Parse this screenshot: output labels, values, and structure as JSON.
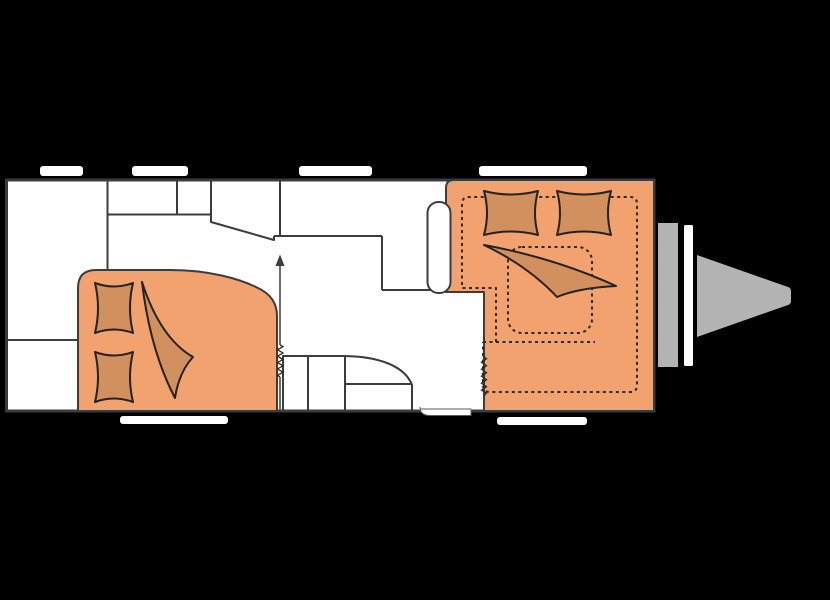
{
  "scene": {
    "type": "caravan-floorplan-diagram",
    "background": "#000000"
  },
  "colors": {
    "floor": "#ffffff",
    "wall": "#3c3c3c",
    "upholstery": "#f2a26e",
    "bedding": "#d2905f",
    "bedding_outline": "#222222",
    "dashed_outline": "#2a2a2a",
    "hitch_gray": "#b3b3b3",
    "window_white": "#ffffff"
  }
}
